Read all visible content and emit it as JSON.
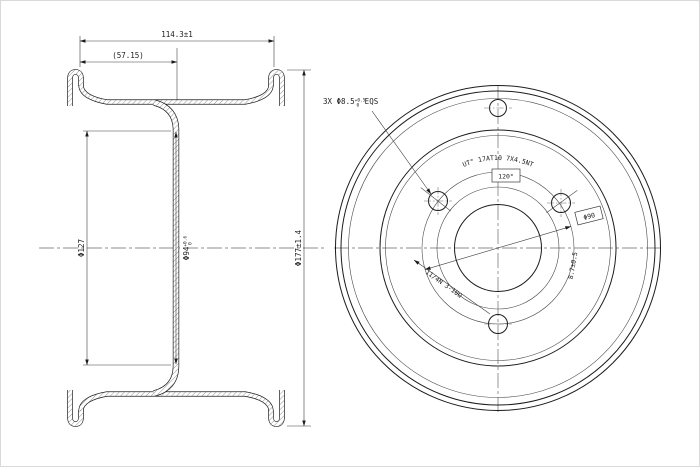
{
  "drawing": {
    "background": "#ffffff",
    "line_color": "#1c1c1c",
    "section_view": {
      "dim_width": "114.3±1",
      "dim_half_width": "(57.15)",
      "dim_flange_diameter": "Φ127",
      "dim_pilot_main": "Φ94",
      "dim_pilot_tol_upper": "+0.6",
      "dim_pilot_tol_lower": "0",
      "dim_outer_diameter": "Φ177±1.4"
    },
    "front_view": {
      "bolt_hole_prefix": "3X Φ8.5",
      "bolt_hole_tol_upper": "+0.5",
      "bolt_hole_tol_lower": "0",
      "bolt_hole_suffix": " EQS",
      "brand_arc_text": "UT°  17AT10  7X4.5NT",
      "angle_label": "120°",
      "bolt_circle_label": "Φ90",
      "radial_dimension": "8.7±0.5",
      "valve_note": "11/4N 3-10Ω"
    }
  }
}
